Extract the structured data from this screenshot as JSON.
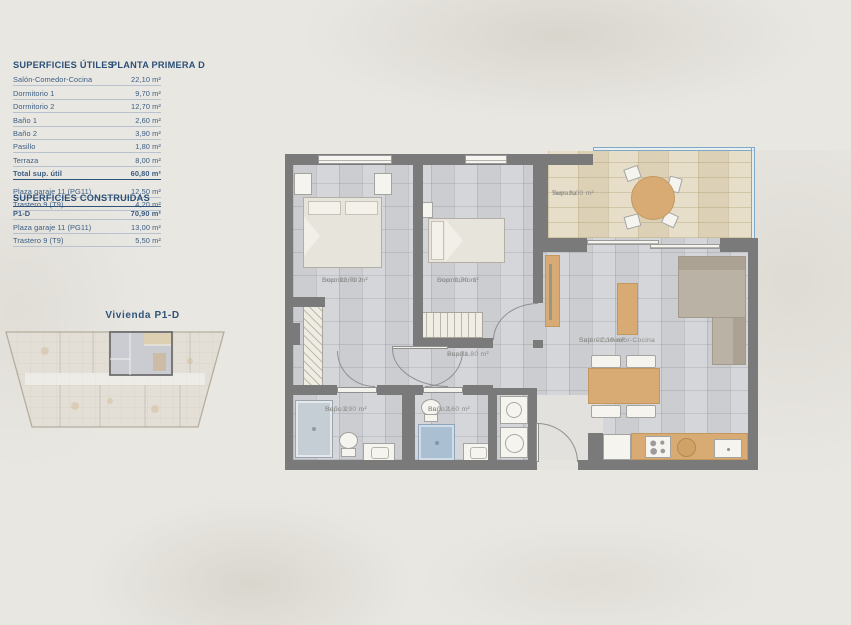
{
  "colors": {
    "accent_navy": "#2f5378",
    "row_text": "#3a5d82",
    "wall_gray": "#7a7a7a",
    "floor_tile": "#d3d4d7",
    "terrace_tile": "#e2d8bf",
    "glass_blue": "#7fa9c8",
    "wood_tan": "#d8ab74",
    "paper": "#e9e7e2"
  },
  "tables": {
    "utiles": {
      "title": "SUPERFICIES ÚTILES",
      "planta": "PLANTA PRIMERA D",
      "rows": [
        {
          "label": "Salón-Comedor-Cocina",
          "value": "22,10 m²"
        },
        {
          "label": "Dormitorio 1",
          "value": "9,70 m²"
        },
        {
          "label": "Dormitorio 2",
          "value": "12,70 m²"
        },
        {
          "label": "Baño 1",
          "value": "2,60 m²"
        },
        {
          "label": "Baño 2",
          "value": "3,90 m²"
        },
        {
          "label": "Pasillo",
          "value": "1,80 m²"
        },
        {
          "label": "Terraza",
          "value": "8,00 m²"
        }
      ],
      "total": {
        "label": "Total sup. útil",
        "value": "60,80 m²"
      },
      "extras": [
        {
          "label": "Plaza garaje 11 (PG11)",
          "value": "12,50 m²"
        },
        {
          "label": "Trastero 9 (T9)",
          "value": "4,20 m²"
        }
      ]
    },
    "construidas": {
      "title": "SUPERFICIES CONSTRUIDAS",
      "rows": [
        {
          "label": "P1-D",
          "value": "70,90 m²"
        },
        {
          "label": "Plaza garaje 11 (PG11)",
          "value": "13,00 m²"
        },
        {
          "label": "Trastero 9 (T9)",
          "value": "5,50 m²"
        }
      ]
    }
  },
  "overview": {
    "title": "Vivienda P1-D"
  },
  "plan": {
    "rooms": {
      "dormitorio2": {
        "label": "Dormitorio 2",
        "sup": "Sup: 12,70 m²"
      },
      "dormitorio1": {
        "label": "Dormitorio 1",
        "sup": "Sup: 9,70 m²"
      },
      "terraza": {
        "label": "Terraza",
        "sup": "Sup: 8,00 m²"
      },
      "salon": {
        "label": "Salón-Comedor-Cocina",
        "sup": "Sup: 22,10 m²"
      },
      "pasillo": {
        "label": "Pasillo",
        "sup": "Sup: 1,80 m²"
      },
      "bano2": {
        "label": "Baño 2",
        "sup": "Sup: 3,90 m²"
      },
      "bano1": {
        "label": "Baño 1",
        "sup": "Sup: 2,60 m²"
      }
    }
  }
}
